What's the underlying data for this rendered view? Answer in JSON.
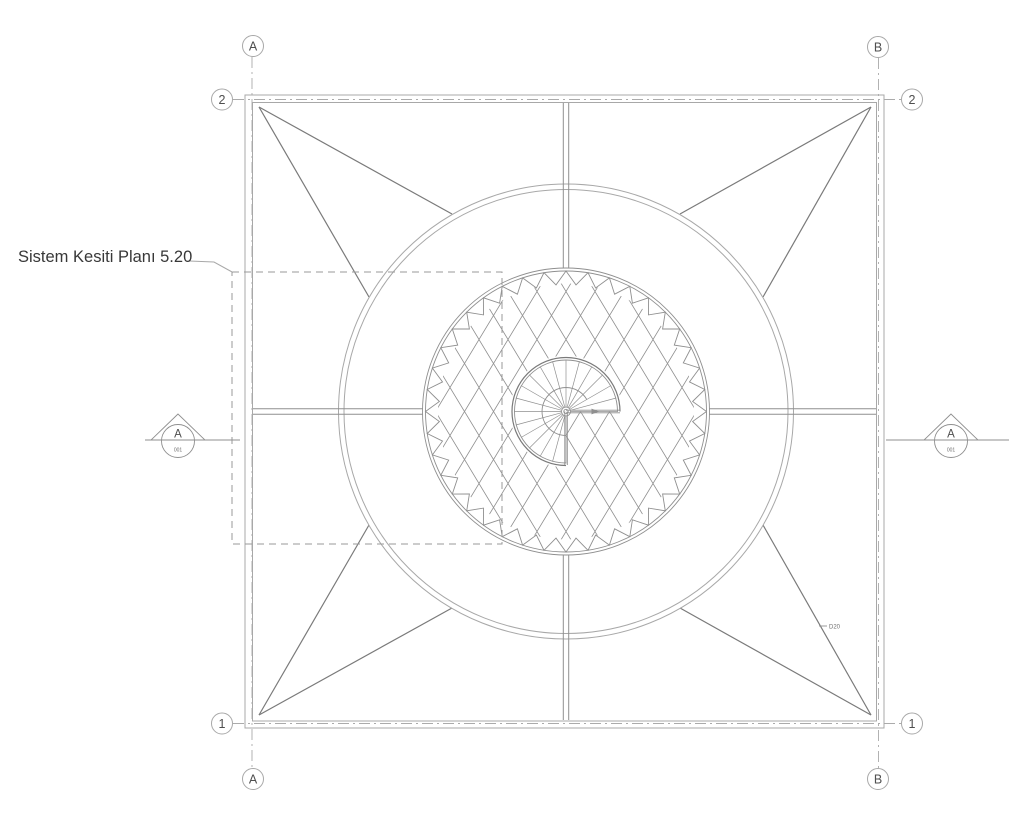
{
  "drawing": {
    "title": "Sistem Kesiti Planı 5.20",
    "member_tag": "D20"
  },
  "grid": {
    "columns": [
      {
        "label": "A"
      },
      {
        "label": "B"
      }
    ],
    "rows": [
      {
        "label": "1"
      },
      {
        "label": "2"
      }
    ]
  },
  "section_markers": {
    "left": {
      "label": "A",
      "sheet": "001"
    },
    "right": {
      "label": "A",
      "sheet": "001"
    }
  },
  "colors": {
    "background": "#ffffff",
    "line_light": "#a8a8a8",
    "line_mid": "#8f8f8f",
    "line_dark": "#7a7a7a",
    "text_primary": "#383838",
    "text_secondary": "#6e6e6e"
  }
}
